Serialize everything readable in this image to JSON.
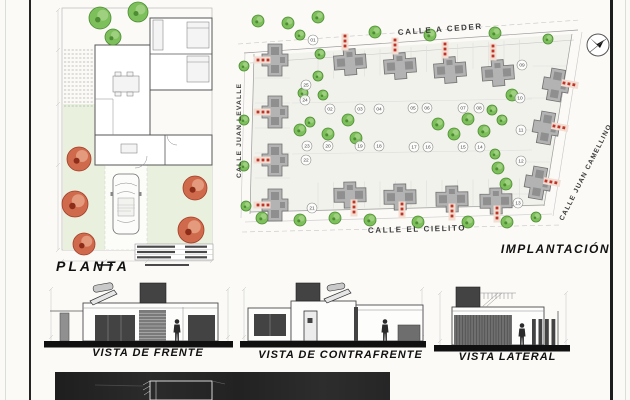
{
  "sheet": {
    "bg": "#fbfaf7",
    "border_color": "#1d1d1d"
  },
  "floor_plan": {
    "label": "PLANTA",
    "green_trees": [
      [
        65,
        14,
        11
      ],
      [
        103,
        8,
        10
      ],
      [
        78,
        33,
        8
      ]
    ],
    "red_trees": [
      [
        44,
        155,
        12
      ],
      [
        40,
        200,
        13
      ],
      [
        49,
        240,
        11
      ],
      [
        160,
        184,
        12
      ],
      [
        156,
        226,
        13
      ]
    ]
  },
  "site_plan": {
    "label": "IMPLANTACIÓN",
    "north_icon": "north-arrow",
    "streets": {
      "top": "CALLE A CEDER",
      "left": "CALLE JUAN LEVALLE",
      "right": "CALLE JUAN CAMELLINO",
      "bottom": "CALLE EL CIELITO"
    },
    "lots": [
      {
        "n": "01",
        "x": 83,
        "y": 32
      },
      {
        "n": "02",
        "x": 100,
        "y": 101
      },
      {
        "n": "03",
        "x": 130,
        "y": 101
      },
      {
        "n": "04",
        "x": 149,
        "y": 101
      },
      {
        "n": "05",
        "x": 183,
        "y": 100
      },
      {
        "n": "06",
        "x": 197,
        "y": 100
      },
      {
        "n": "07",
        "x": 233,
        "y": 100
      },
      {
        "n": "08",
        "x": 249,
        "y": 100
      },
      {
        "n": "09",
        "x": 292,
        "y": 57
      },
      {
        "n": "10",
        "x": 290,
        "y": 90
      },
      {
        "n": "11",
        "x": 291,
        "y": 122
      },
      {
        "n": "12",
        "x": 291,
        "y": 153
      },
      {
        "n": "13",
        "x": 288,
        "y": 195
      },
      {
        "n": "14",
        "x": 250,
        "y": 139
      },
      {
        "n": "15",
        "x": 233,
        "y": 139
      },
      {
        "n": "16",
        "x": 198,
        "y": 139
      },
      {
        "n": "17",
        "x": 184,
        "y": 139
      },
      {
        "n": "18",
        "x": 149,
        "y": 138
      },
      {
        "n": "19",
        "x": 130,
        "y": 138
      },
      {
        "n": "20",
        "x": 98,
        "y": 138
      },
      {
        "n": "21",
        "x": 82,
        "y": 200
      },
      {
        "n": "22",
        "x": 76,
        "y": 152
      },
      {
        "n": "23",
        "x": 77,
        "y": 138
      },
      {
        "n": "24",
        "x": 75,
        "y": 92
      },
      {
        "n": "25",
        "x": 76,
        "y": 77
      }
    ],
    "houses": [
      [
        120,
        54,
        -4
      ],
      [
        170,
        58,
        -4
      ],
      [
        220,
        62,
        -4
      ],
      [
        268,
        65,
        -4
      ],
      [
        120,
        187,
        -1
      ],
      [
        170,
        189,
        -1
      ],
      [
        222,
        191,
        -1
      ],
      [
        266,
        193,
        -1
      ],
      [
        45,
        52,
        90
      ],
      [
        45,
        104,
        90
      ],
      [
        45,
        152,
        90
      ],
      [
        45,
        197,
        90
      ],
      [
        326,
        77,
        100
      ],
      [
        316,
        120,
        100
      ],
      [
        308,
        175,
        100
      ]
    ],
    "walkways": [
      [
        115,
        28,
        0
      ],
      [
        165,
        32,
        0
      ],
      [
        215,
        36,
        0
      ],
      [
        263,
        38,
        0
      ],
      [
        124,
        194,
        0
      ],
      [
        172,
        196,
        0
      ],
      [
        222,
        198,
        0
      ],
      [
        267,
        200,
        0
      ],
      [
        38,
        52,
        90
      ],
      [
        38,
        104,
        90
      ],
      [
        38,
        152,
        90
      ],
      [
        38,
        197,
        90
      ],
      [
        334,
        75,
        -80
      ],
      [
        324,
        118,
        -80
      ],
      [
        316,
        173,
        -80
      ]
    ],
    "trees": [
      [
        28,
        13,
        6
      ],
      [
        58,
        15,
        6
      ],
      [
        88,
        9,
        6
      ],
      [
        145,
        24,
        6
      ],
      [
        200,
        27,
        6
      ],
      [
        265,
        25,
        6
      ],
      [
        318,
        31,
        5
      ],
      [
        14,
        58,
        5
      ],
      [
        14,
        112,
        5
      ],
      [
        14,
        158,
        5
      ],
      [
        16,
        198,
        5
      ],
      [
        32,
        210,
        6
      ],
      [
        70,
        212,
        6
      ],
      [
        105,
        210,
        6
      ],
      [
        140,
        212,
        6
      ],
      [
        188,
        214,
        6
      ],
      [
        238,
        214,
        6
      ],
      [
        277,
        214,
        6
      ],
      [
        306,
        209,
        5
      ],
      [
        70,
        27,
        5
      ],
      [
        90,
        46,
        5
      ],
      [
        88,
        68,
        5
      ],
      [
        73,
        85,
        5
      ],
      [
        93,
        87,
        5
      ],
      [
        270,
        67,
        6
      ],
      [
        282,
        87,
        6
      ],
      [
        262,
        102,
        5
      ],
      [
        272,
        112,
        5
      ],
      [
        70,
        122,
        6
      ],
      [
        80,
        114,
        5
      ],
      [
        98,
        126,
        6
      ],
      [
        118,
        112,
        6
      ],
      [
        126,
        130,
        6
      ],
      [
        208,
        116,
        6
      ],
      [
        224,
        126,
        6
      ],
      [
        238,
        111,
        6
      ],
      [
        254,
        123,
        6
      ],
      [
        265,
        146,
        5
      ],
      [
        268,
        160,
        6
      ],
      [
        276,
        176,
        6
      ]
    ],
    "colors": {
      "tree_fill": "#7cbf5b",
      "tree_stroke": "#4d8c33",
      "tree_light": "#9ed07f",
      "house_fill": "#b3b3b3",
      "house_stroke": "#6f6f6f",
      "house_dark": "#8f8f8f",
      "red_dot": "#c13327",
      "walkway": "#f2ddd2",
      "red_tree_fill": "#d06a4c",
      "red_tree_stroke": "#a33d28",
      "red_tree_light": "#e49a7d",
      "street_line": "#9a9a9a",
      "lot_line": "#dcdcdc",
      "block_fill": "#f2f2ec"
    }
  },
  "elevations": [
    {
      "label": "VISTA DE FRENTE"
    },
    {
      "label": "VISTA DE CONTRAFRENTE"
    },
    {
      "label": "VISTA LATERAL"
    }
  ]
}
